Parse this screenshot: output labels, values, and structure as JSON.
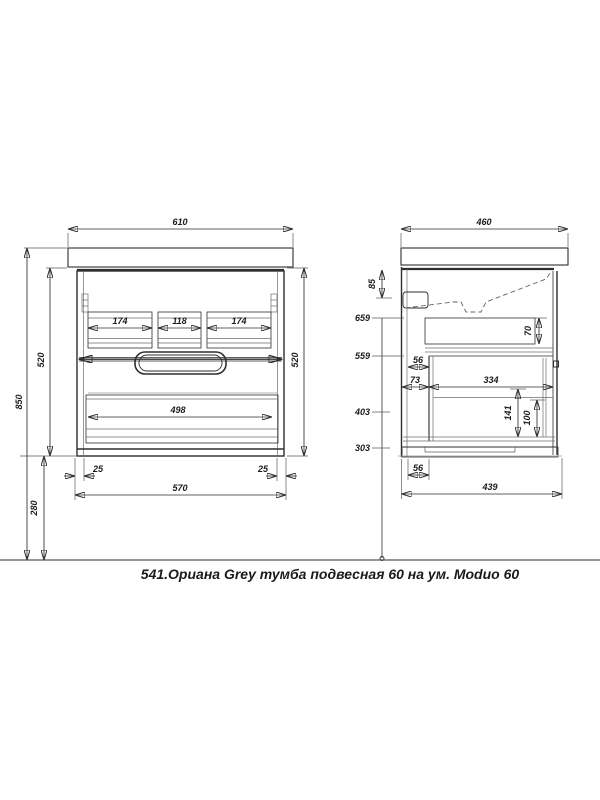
{
  "caption": "541.Ориана Grey тумба подвесная 60 на ум. Moduo 60",
  "front_view": {
    "dims": {
      "top_width": "610",
      "overall_height": "850",
      "cabinet_height_left": "520",
      "cabinet_height_right": "520",
      "drawer_section_left": "174",
      "drawer_section_center": "118",
      "drawer_section_right": "174",
      "bottom_drawer_width": "498",
      "side_inset_left": "25",
      "side_inset_right": "25",
      "bottom_width": "570",
      "floor_clearance": "280"
    }
  },
  "side_view": {
    "dims": {
      "top_depth": "460",
      "basin_drop": "85",
      "height_top_shelf": "659",
      "height_mid_shelf": "559",
      "height_rail": "403",
      "height_bottom": "303",
      "top_drawer_depth": "70",
      "front_gap_top": "56",
      "front_offset": "73",
      "inner_depth": "334",
      "rail_height": "141",
      "rail_height_inner": "100",
      "front_gap_bottom": "56",
      "bottom_depth": "439"
    }
  }
}
